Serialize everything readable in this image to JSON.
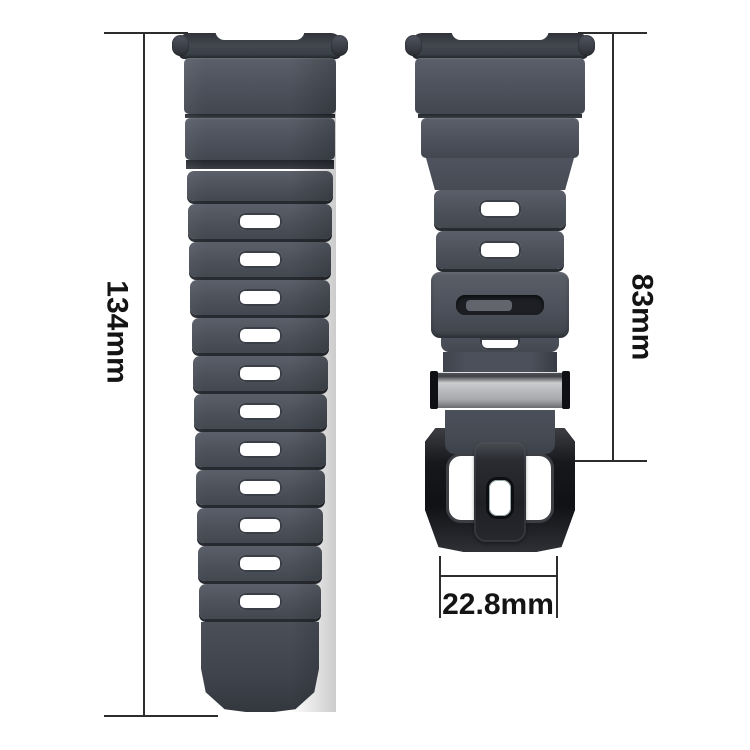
{
  "diagram": {
    "title": "Watch strap dimension diagram",
    "subject": "two-piece rubber smartwatch strap with black buckle"
  },
  "dimensions": {
    "left_strap_length": "134mm",
    "right_strap_length": "83mm",
    "buckle_width": "22.8mm"
  },
  "left_strap": {
    "hole_count": 11
  },
  "right_strap": {
    "hole_count": 2,
    "partial_hole_visible": true
  },
  "colors": {
    "background": "#ffffff",
    "strap": "#4c515b",
    "strap_light": "#5a5f69",
    "strap_dark": "#33363d",
    "groove": "#272a30",
    "hole": "#ffffff",
    "metal_slider": "#b5b7ba",
    "buckle": "#1d1e22",
    "annotation_line": "#2d2d2d",
    "annotation_text": "#141414"
  }
}
